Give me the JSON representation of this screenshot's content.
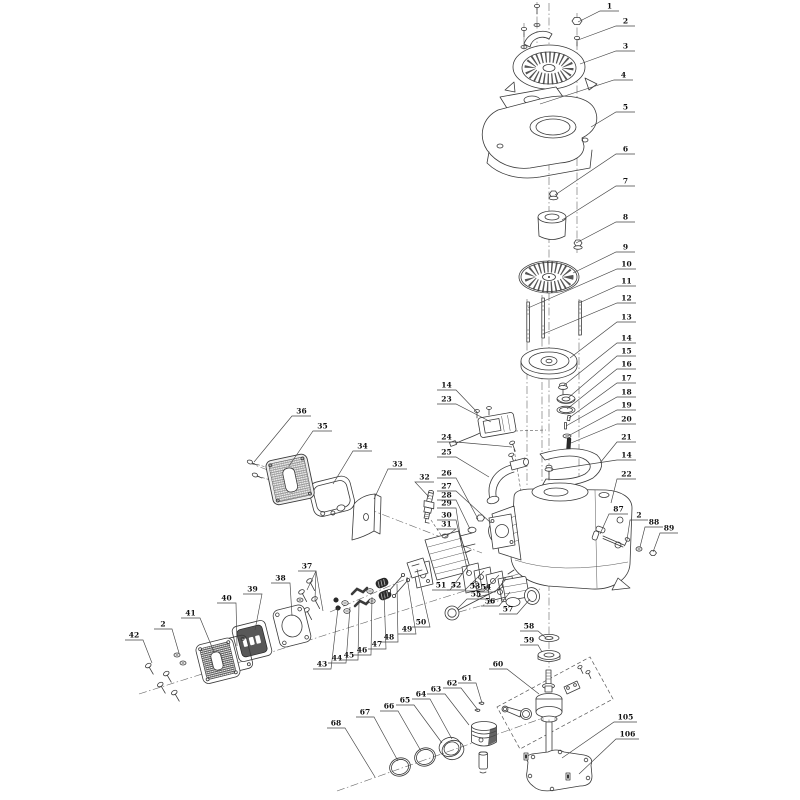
{
  "diagram": {
    "kind": "exploded-parts-diagram",
    "colors": {
      "background": "#ffffff",
      "line": "#3a3a3a",
      "label": "#111111"
    },
    "callouts": [
      {
        "t": "1",
        "pts": [
          [
            619,
            11
          ],
          [
            600,
            11
          ],
          [
            578,
            22
          ]
        ]
      },
      {
        "t": "2",
        "pts": [
          [
            635,
            26
          ],
          [
            616,
            26
          ],
          [
            578,
            40
          ]
        ]
      },
      {
        "t": "3",
        "pts": [
          [
            635,
            51
          ],
          [
            616,
            51
          ],
          [
            580,
            64
          ]
        ]
      },
      {
        "t": "4",
        "pts": [
          [
            633,
            80
          ],
          [
            614,
            80
          ],
          [
            540,
            104
          ]
        ]
      },
      {
        "t": "5",
        "pts": [
          [
            635,
            112
          ],
          [
            616,
            112
          ],
          [
            591,
            127
          ]
        ]
      },
      {
        "t": "6",
        "pts": [
          [
            635,
            154
          ],
          [
            616,
            154
          ],
          [
            555,
            195
          ]
        ]
      },
      {
        "t": "7",
        "pts": [
          [
            635,
            186
          ],
          [
            616,
            186
          ],
          [
            562,
            220
          ]
        ]
      },
      {
        "t": "8",
        "pts": [
          [
            635,
            222
          ],
          [
            616,
            222
          ],
          [
            576,
            243
          ]
        ]
      },
      {
        "t": "9",
        "pts": [
          [
            635,
            252
          ],
          [
            616,
            252
          ],
          [
            573,
            273
          ]
        ]
      },
      {
        "t": "10",
        "pts": [
          [
            636,
            269
          ],
          [
            617,
            269
          ],
          [
            528,
            308
          ]
        ]
      },
      {
        "t": "11",
        "pts": [
          [
            636,
            286
          ],
          [
            617,
            286
          ],
          [
            579,
            303
          ]
        ]
      },
      {
        "t": "12",
        "pts": [
          [
            636,
            303
          ],
          [
            617,
            303
          ],
          [
            543,
            334
          ]
        ]
      },
      {
        "t": "13",
        "pts": [
          [
            636,
            322
          ],
          [
            617,
            322
          ],
          [
            570,
            358
          ]
        ]
      },
      {
        "t": "14",
        "pts": [
          [
            636,
            343
          ],
          [
            617,
            343
          ],
          [
            563,
            386
          ]
        ]
      },
      {
        "t": "15",
        "pts": [
          [
            636,
            356
          ],
          [
            617,
            356
          ],
          [
            568,
            398
          ]
        ]
      },
      {
        "t": "16",
        "pts": [
          [
            636,
            369
          ],
          [
            617,
            369
          ],
          [
            567,
            409
          ]
        ]
      },
      {
        "t": "17",
        "pts": [
          [
            636,
            383
          ],
          [
            617,
            383
          ],
          [
            569,
            418
          ]
        ]
      },
      {
        "t": "18",
        "pts": [
          [
            636,
            397
          ],
          [
            617,
            397
          ],
          [
            566,
            426
          ]
        ]
      },
      {
        "t": "19",
        "pts": [
          [
            636,
            410
          ],
          [
            617,
            410
          ],
          [
            568,
            436
          ]
        ]
      },
      {
        "t": "20",
        "pts": [
          [
            636,
            424
          ],
          [
            617,
            424
          ],
          [
            571,
            443
          ]
        ]
      },
      {
        "t": "21",
        "pts": [
          [
            636,
            442
          ],
          [
            617,
            442
          ],
          [
            600,
            463
          ]
        ]
      },
      {
        "t": "14",
        "pts": [
          [
            636,
            460
          ],
          [
            617,
            460
          ],
          [
            551,
            470
          ]
        ]
      },
      {
        "t": "22",
        "pts": [
          [
            636,
            479
          ],
          [
            617,
            479
          ],
          [
            611,
            503
          ]
        ]
      },
      {
        "t": "87",
        "pts": [
          [
            628,
            514
          ],
          [
            609,
            514
          ],
          [
            600,
            534
          ]
        ]
      },
      {
        "t": "2",
        "pts": [
          [
            648,
            520
          ],
          [
            630,
            520
          ],
          [
            627,
            540
          ]
        ]
      },
      {
        "t": "88",
        "pts": [
          [
            663,
            527
          ],
          [
            645,
            527
          ],
          [
            640,
            547
          ]
        ]
      },
      {
        "t": "89",
        "pts": [
          [
            678,
            533
          ],
          [
            660,
            533
          ],
          [
            653,
            552
          ]
        ]
      },
      {
        "t": "14",
        "pts": [
          [
            437,
            390
          ],
          [
            456,
            390
          ],
          [
            477,
            412
          ]
        ]
      },
      {
        "t": "23",
        "pts": [
          [
            437,
            404
          ],
          [
            456,
            404
          ],
          [
            491,
            422
          ]
        ]
      },
      {
        "t": "24",
        "pts": [
          [
            437,
            442
          ],
          [
            456,
            442
          ],
          [
            512,
            447
          ]
        ]
      },
      {
        "t": "25",
        "pts": [
          [
            437,
            457
          ],
          [
            456,
            457
          ],
          [
            489,
            477
          ]
        ]
      },
      {
        "t": "26",
        "pts": [
          [
            437,
            478
          ],
          [
            456,
            478
          ],
          [
            478,
            519
          ]
        ]
      },
      {
        "t": "27",
        "pts": [
          [
            437,
            491
          ],
          [
            456,
            491
          ],
          [
            491,
            523
          ]
        ]
      },
      {
        "t": "28",
        "pts": [
          [
            437,
            500
          ],
          [
            456,
            500
          ],
          [
            470,
            529
          ]
        ]
      },
      {
        "t": "29",
        "pts": [
          [
            437,
            508
          ],
          [
            456,
            508
          ],
          [
            462,
            548
          ]
        ]
      },
      {
        "t": "30",
        "pts": [
          [
            437,
            520
          ],
          [
            456,
            520
          ],
          [
            468,
            573
          ]
        ]
      },
      {
        "t": "31",
        "pts": [
          [
            437,
            529
          ],
          [
            456,
            529
          ],
          [
            444,
            538
          ]
        ]
      },
      {
        "t": "36",
        "pts": [
          [
            311,
            416
          ],
          [
            292,
            416
          ],
          [
            254,
            462
          ]
        ]
      },
      {
        "t": "35",
        "pts": [
          [
            332,
            431
          ],
          [
            313,
            431
          ],
          [
            289,
            466
          ]
        ]
      },
      {
        "t": "34",
        "pts": [
          [
            372,
            451
          ],
          [
            353,
            451
          ],
          [
            333,
            484
          ]
        ]
      },
      {
        "t": "33",
        "pts": [
          [
            407,
            469
          ],
          [
            388,
            469
          ],
          [
            374,
            499
          ]
        ]
      },
      {
        "t": "32",
        "pts": [
          [
            434,
            482
          ],
          [
            415,
            482
          ],
          [
            429,
            497
          ]
        ]
      },
      {
        "t": "37",
        "pts": [
          [
            298,
            571
          ],
          [
            316,
            571
          ],
          [
            307,
            590
          ]
        ],
        "fan": [
          [
            315,
            600
          ],
          [
            323,
            611
          ]
        ]
      },
      {
        "t": "38",
        "pts": [
          [
            271,
            583
          ],
          [
            290,
            583
          ],
          [
            292,
            616
          ]
        ]
      },
      {
        "t": "39",
        "pts": [
          [
            243,
            594
          ],
          [
            262,
            594
          ],
          [
            255,
            630
          ]
        ]
      },
      {
        "t": "40",
        "pts": [
          [
            217,
            603
          ],
          [
            236,
            603
          ],
          [
            237,
            646
          ]
        ]
      },
      {
        "t": "41",
        "pts": [
          [
            181,
            618
          ],
          [
            200,
            618
          ],
          [
            214,
            652
          ]
        ]
      },
      {
        "t": "2",
        "pts": [
          [
            154,
            629
          ],
          [
            172,
            629
          ],
          [
            179,
            653
          ]
        ]
      },
      {
        "t": "42",
        "pts": [
          [
            125,
            640
          ],
          [
            143,
            640
          ],
          [
            152,
            663
          ]
        ]
      },
      {
        "t": "43",
        "pts": [
          [
            313,
            669
          ],
          [
            331,
            669
          ],
          [
            338,
            608
          ]
        ]
      },
      {
        "t": "44",
        "pts": [
          [
            328,
            663
          ],
          [
            346,
            663
          ],
          [
            350,
            607
          ]
        ]
      },
      {
        "t": "45",
        "pts": [
          [
            340,
            660
          ],
          [
            358,
            660
          ],
          [
            359,
            601
          ]
        ]
      },
      {
        "t": "46",
        "pts": [
          [
            353,
            655
          ],
          [
            371,
            655
          ],
          [
            372,
            597
          ]
        ]
      },
      {
        "t": "47",
        "pts": [
          [
            368,
            649
          ],
          [
            386,
            649
          ],
          [
            384,
            591
          ]
        ]
      },
      {
        "t": "48",
        "pts": [
          [
            380,
            642
          ],
          [
            398,
            642
          ],
          [
            397,
            584
          ]
        ]
      },
      {
        "t": "49",
        "pts": [
          [
            398,
            634
          ],
          [
            416,
            634
          ],
          [
            407,
            577
          ]
        ]
      },
      {
        "t": "50",
        "pts": [
          [
            412,
            627
          ],
          [
            430,
            627
          ],
          [
            417,
            569
          ]
        ]
      },
      {
        "t": "51",
        "pts": [
          [
            432,
            590
          ],
          [
            450,
            590
          ],
          [
            468,
            566
          ]
        ]
      },
      {
        "t": "52",
        "pts": [
          [
            447,
            590
          ],
          [
            465,
            590
          ],
          [
            484,
            571
          ]
        ]
      },
      {
        "t": "53",
        "pts": [
          [
            466,
            591
          ],
          [
            484,
            591
          ],
          [
            499,
            575
          ]
        ]
      },
      {
        "t": "54",
        "pts": [
          [
            477,
            592
          ],
          [
            495,
            592
          ],
          [
            506,
            579
          ]
        ]
      },
      {
        "t": "55",
        "pts": [
          [
            485,
            599
          ],
          [
            467,
            599
          ],
          [
            457,
            609
          ]
        ]
      },
      {
        "t": "56",
        "pts": [
          [
            481,
            606
          ],
          [
            499,
            606
          ],
          [
            510,
            592
          ]
        ]
      },
      {
        "t": "57",
        "pts": [
          [
            499,
            614
          ],
          [
            517,
            614
          ],
          [
            530,
            599
          ]
        ]
      },
      {
        "t": "58",
        "pts": [
          [
            520,
            631
          ],
          [
            538,
            631
          ],
          [
            545,
            637
          ]
        ]
      },
      {
        "t": "59",
        "pts": [
          [
            520,
            645
          ],
          [
            538,
            645
          ],
          [
            542,
            652
          ]
        ]
      },
      {
        "t": "60",
        "pts": [
          [
            489,
            669
          ],
          [
            507,
            669
          ],
          [
            539,
            694
          ]
        ]
      },
      {
        "t": "61",
        "pts": [
          [
            458,
            683
          ],
          [
            476,
            683
          ],
          [
            482,
            703
          ]
        ]
      },
      {
        "t": "62",
        "pts": [
          [
            443,
            688
          ],
          [
            461,
            688
          ],
          [
            478,
            710
          ]
        ]
      },
      {
        "t": "63",
        "pts": [
          [
            427,
            694
          ],
          [
            445,
            694
          ],
          [
            469,
            725
          ]
        ]
      },
      {
        "t": "64",
        "pts": [
          [
            412,
            699
          ],
          [
            430,
            699
          ],
          [
            452,
            739
          ]
        ]
      },
      {
        "t": "65",
        "pts": [
          [
            396,
            705
          ],
          [
            414,
            705
          ],
          [
            442,
            743
          ]
        ]
      },
      {
        "t": "66",
        "pts": [
          [
            380,
            711
          ],
          [
            398,
            711
          ],
          [
            421,
            751
          ]
        ]
      },
      {
        "t": "67",
        "pts": [
          [
            356,
            717
          ],
          [
            374,
            717
          ],
          [
            398,
            761
          ]
        ]
      },
      {
        "t": "68",
        "pts": [
          [
            327,
            728
          ],
          [
            345,
            728
          ],
          [
            375,
            777
          ]
        ]
      },
      {
        "t": "105",
        "pts": [
          [
            637,
            722
          ],
          [
            614,
            722
          ],
          [
            562,
            758
          ]
        ]
      },
      {
        "t": "106",
        "pts": [
          [
            639,
            739
          ],
          [
            616,
            739
          ],
          [
            579,
            774
          ]
        ]
      }
    ]
  }
}
